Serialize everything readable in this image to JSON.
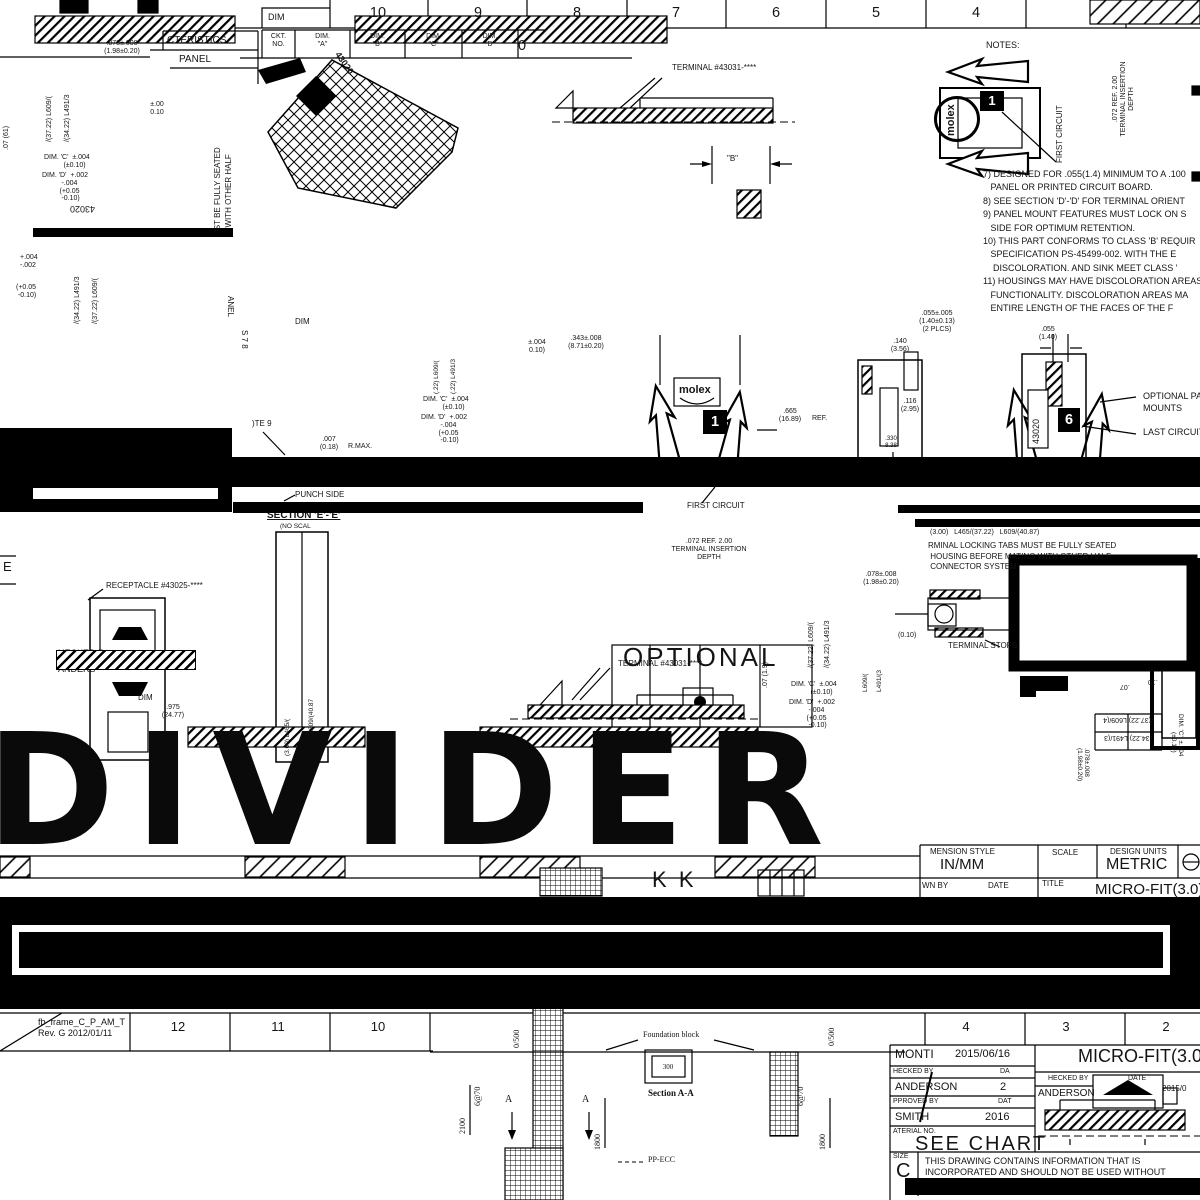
{
  "rulers": {
    "top_cells": [
      "10",
      "9",
      "8",
      "7",
      "6",
      "5",
      "4"
    ],
    "top_dim_label": "DIM",
    "zone_zero": "0",
    "zone_e": "E",
    "bottom_left_cells": [
      "12",
      "11",
      "10"
    ],
    "bottom_right_cells": [
      "4",
      "3",
      "2"
    ],
    "frame_name": "fb_frame_C_P_AM_T",
    "frame_rev": "Rev. G 2012/01/11"
  },
  "char_table": {
    "header": "CTERISTICS",
    "sub": "PANEL",
    "cols": [
      "CKT.\nNO.",
      "DIM.\n\"A\"",
      "DIM.\n\"B\"",
      "DIM.\n\"C\"",
      "DIM.\n\"D\""
    ]
  },
  "notes": {
    "title": "NOTES:",
    "body": "7) DESIGNED FOR .055(1.4) MINIMUM TO A .100\n   PANEL OR PRINTED CIRCUIT BOARD.\n8) SEE SECTION 'D'-'D' FOR TERMINAL ORIENT\n9) PANEL MOUNT FEATURES MUST LOCK ON S\n   SIDE FOR OPTIMUM RETENTION.\n10) THIS PART CONFORMS TO CLASS 'B' REQUIR\n   SPECIFICATION PS-45499-002. WITH THE E\n    DISCOLORATION. AND SINK MEET CLASS '\n11) HOUSINGS MAY HAVE DISCOLORATION AREAS\n   FUNCTIONALITY. DISCOLORATION AREAS MA\n   ENTIRE LENGTH OF THE FACES OF THE F"
  },
  "labels": {
    "terminal": "TERMINAL #43031-****",
    "receptacle": "RECEPTACLE #43025-****",
    "first_circuit": "FIRST CIRCUIT",
    "last_circuit": "LAST CIRCUIT",
    "opm1": "OPTIONAL PANEL",
    "opm2": "MOUNTS",
    "punch_side": "PUNCH SIDE",
    "section_ee": "SECTION 'E'-'E'",
    "no_scale": "(NO SCAL",
    "terminal_stops": "TERMINAL STOPS",
    "locking": "RMINAL LOCKING TABS MUST BE FULLY SEATED\n HOUSING BEFORE MATING WITH OTHER HALF\n CONNECTOR SYSTEM",
    "optional": "OPTIONAL",
    "note9": ")TE 9",
    "b": "\"B\"",
    "checked1": "HECKED B",
    "checked2": "ANDERS",
    "dim": "DIM",
    "seated": "UST BE FULLY SEATED",
    "other_half": "G WITH OTHER HALF",
    "panel_v": "ANEL",
    "s78": "S 7 8",
    "n43020": "43020",
    "molex": "molex",
    "one": "1",
    "six": "6",
    "kk": "K  K"
  },
  "dims": {
    "d0": ".078±.008\n(1.98±0.20)",
    "d1": "±.00\n0.10",
    "d2": "DIM. 'C'  ±.004\n          (±0.10)",
    "d3": "DIM. 'D'  +.002\n          -.004\n         (+0.05\n          -0.10)",
    "d4": "/(37.22) L609/(",
    "d5": "/(34.22) L491/3",
    "d6": ".07 (61)",
    "d10": "+.004\n-.002",
    "d10b": "(+0.05\n -0.10)",
    "d11": ".343±.008\n(8.71±0.20)",
    "d12": "±.004\n0.10)",
    "d13": "(.22) L609/(",
    "d14": "(.22) L491/3",
    "d17": ".055±.005\n(1.40±0.13)\n(2 PLCS)",
    "d18": ".055\n(1.40)",
    "d19": ".140\n(3.56)",
    "d20": ".116\n(2.95)",
    "d21": ".665\n(16.89)",
    "d21b": "REF.",
    "d22": ".330\n8.38",
    "d23": ".007\n(0.18)",
    "d23b": "R.MAX.",
    "d24": "(3.00)   L465/(37.22)   L609/(40.87)",
    "insertion": ".072 REF. 2.00\nTERMINAL INSERTION\nDEPTH",
    "d29": ".07 (1.9)",
    "l609": "L609/(",
    "l491": "L491/(3",
    "d33": "(0.10)",
    "d34": "(3.00) L465/(",
    "d35": "(37.22) L609/(40.87",
    "mt1": "/(37.22) L609/(4",
    "mt2": "(34.22) L491/(3",
    "d39a": ".07",
    "d39b": ".10",
    "d32": ".975\n(24.77)"
  },
  "foundation": {
    "label": "Foundation block",
    "section": "Section A-A",
    "d300": "300",
    "pp": "PP-ECC",
    "g670": "6@70",
    "d2100": "2100",
    "d1800": "1800",
    "d0500": "0/500",
    "a": "A"
  },
  "title_block": {
    "dim_style_label": "MENSION STYLE",
    "dim_style": "IN/MM",
    "scale_label": "SCALE",
    "units_label": "DESIGN UNITS",
    "units": "METRIC",
    "drawn_label": "WN BY",
    "date_label": "DATE",
    "title_label": "TITLE",
    "title": "MICRO-FIT(3.0)"
  },
  "approval": {
    "drawn": "MONTI",
    "drawn_date": "2015/06/16",
    "checked_label": "HECKED BY",
    "checked_date_label": "DA",
    "checked": "ANDERSON",
    "checked_date": "2",
    "approved_label": "PPROVED BY",
    "approved_date_label": "DAT",
    "approved": "SMITH",
    "approved_date": "2016",
    "material_label": "ATERIAL NO.",
    "material": "SEE CHART",
    "size_label": "SIZE",
    "size": "C",
    "conf1": "THIS DRAWING CONTAINS INFORMATION THAT IS",
    "conf2": "INCORPORATED AND SHOULD NOT BE USED WITHOUT",
    "title2": "MICRO-FIT(3.0)",
    "checked2_label": "HECKED BY",
    "date2_label": "DATE",
    "checked2": "ANDERSON",
    "checked2_date": "2015/0"
  },
  "divider_text": "DIVIDER"
}
